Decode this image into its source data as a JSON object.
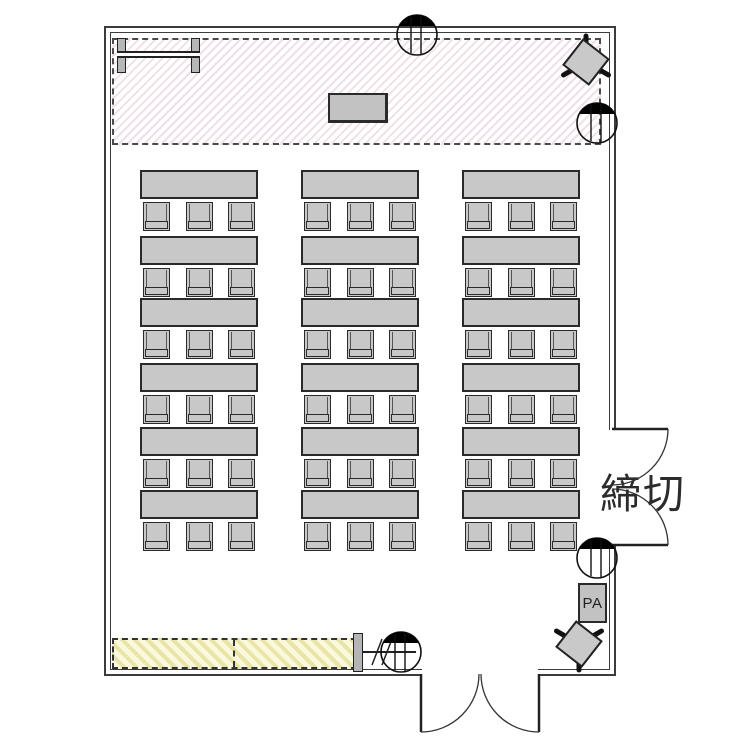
{
  "labels": {
    "closed": "締切",
    "pa": "PA"
  },
  "seating": {
    "rows": 6,
    "columns": 3,
    "chairs_per_table": 3,
    "table_count": 18,
    "seat_count": 54
  },
  "colors": {
    "furniture_fill": "#c8c8c8",
    "wall_line": "#3c3c3c",
    "stage_hatch": "#eee0e8",
    "bench_hatch": "#e9e5a9"
  },
  "icons": {
    "wall_speaker": "circle-with-black-dome",
    "stand_speaker": "tilted-box-on-tripod-legs",
    "door": "quarter-circle-swing-arc",
    "whiteboard": "bar-between-two-posts"
  }
}
